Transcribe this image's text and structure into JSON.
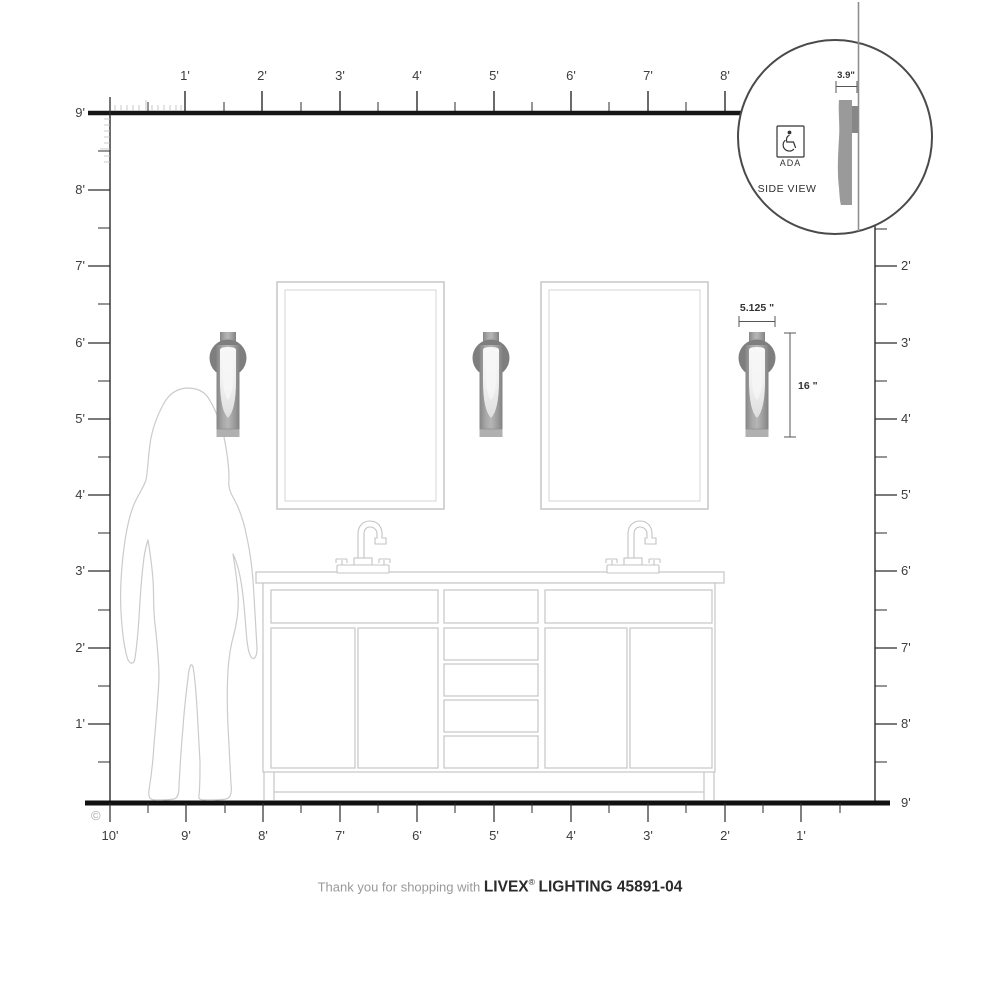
{
  "colors": {
    "ruler_line": "#1a1a1a",
    "tick_label": "#3d3d3d",
    "outline": "#c6c6c6",
    "figure_outline": "#cbcbcb",
    "fixture_body": "#9a9a9a",
    "fixture_backplate": "#7e7e7e",
    "fixture_glass": "#f1f1f1",
    "inset_stroke": "#4a4a4a",
    "dimension_text": "#333333",
    "footer_muted": "#999999",
    "footer_strong": "#2b2b2b"
  },
  "rulers": {
    "top": {
      "labels": [
        "1'",
        "2'",
        "3'",
        "4'",
        "5'",
        "6'",
        "7'",
        "8'"
      ]
    },
    "left": {
      "labels": [
        "9'",
        "8'",
        "7'",
        "6'",
        "5'",
        "4'",
        "3'",
        "2'",
        "1'"
      ]
    },
    "right": {
      "labels": [
        "2'",
        "3'",
        "4'",
        "5'",
        "6'",
        "7'",
        "8'",
        "9'"
      ]
    },
    "bottom": {
      "labels": [
        "10'",
        "9'",
        "8'",
        "7'",
        "6'",
        "5'",
        "4'",
        "3'",
        "2'",
        "1'"
      ]
    }
  },
  "dimensions": {
    "fixture_width": "5.125 \"",
    "fixture_height": "16 \"",
    "fixture_depth": "3.9\""
  },
  "inset": {
    "ada_label": "ADA",
    "side_view_label": "SIDE VIEW"
  },
  "footer": {
    "prefix": "Thank you for shopping with",
    "brand": "LIVEX",
    "registered": "®",
    "suffix": "LIGHTING 45891-04"
  },
  "copyright": "©"
}
